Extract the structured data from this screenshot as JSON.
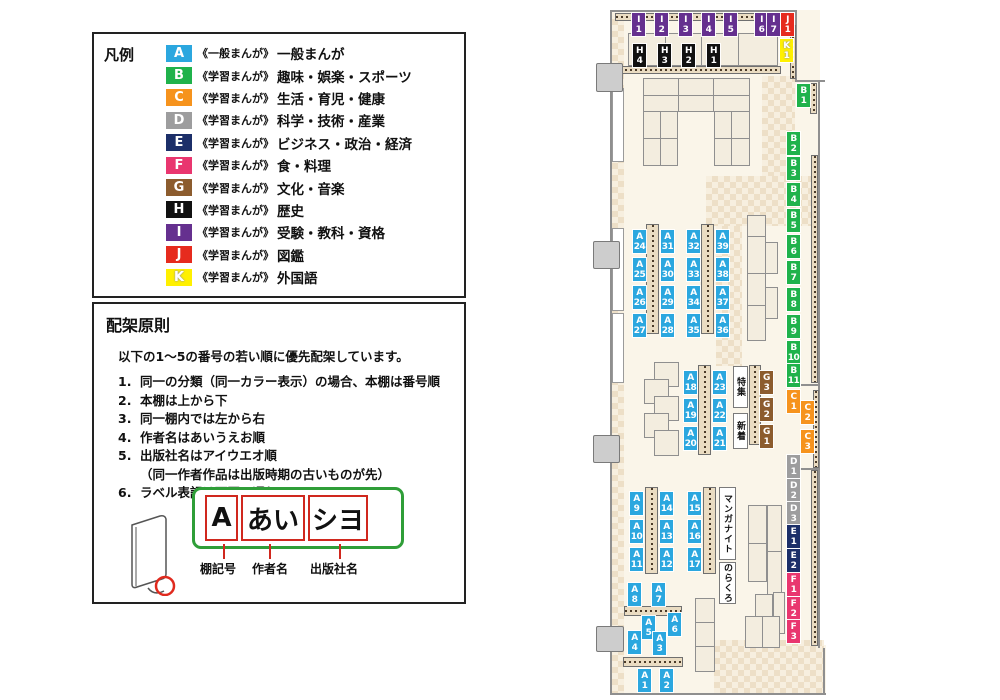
{
  "legend": {
    "title": "凡例",
    "items": [
      {
        "code": "A",
        "color": "#2BA7DF",
        "category": "《一般まんが》",
        "label": "一般まんが"
      },
      {
        "code": "B",
        "color": "#1FB24B",
        "category": "《学習まんが》",
        "label": "趣味・娯楽・スポーツ"
      },
      {
        "code": "C",
        "color": "#F6931D",
        "category": "《学習まんが》",
        "label": "生活・育児・健康"
      },
      {
        "code": "D",
        "color": "#9D9D9E",
        "category": "《学習まんが》",
        "label": "科学・技術・産業"
      },
      {
        "code": "E",
        "color": "#1C2F69",
        "category": "《学習まんが》",
        "label": "ビジネス・政治・経済"
      },
      {
        "code": "F",
        "color": "#E9366F",
        "category": "《学習まんが》",
        "label": "食・料理"
      },
      {
        "code": "G",
        "color": "#8C5C2E",
        "category": "《学習まんが》",
        "label": "文化・音楽"
      },
      {
        "code": "H",
        "color": "#111111",
        "category": "《学習まんが》",
        "label": "歴史"
      },
      {
        "code": "I",
        "color": "#65308F",
        "category": "《学習まんが》",
        "label": "受験・教科・資格"
      },
      {
        "code": "J",
        "color": "#E62B1E",
        "category": "《学習まんが》",
        "label": "図鑑"
      },
      {
        "code": "K",
        "color": "#FFF000",
        "category": "《学習まんが》",
        "label": "外国語"
      }
    ]
  },
  "principles": {
    "title": "配架原則",
    "intro": "以下の1〜5の番号の若い順に優先配架しています。",
    "rules": [
      {
        "n": "1.",
        "t": "同一の分類（同一カラー表示）の場合、本棚は番号順"
      },
      {
        "n": "2.",
        "t": "本棚は上から下"
      },
      {
        "n": "3.",
        "t": "同一棚内では左から右"
      },
      {
        "n": "4.",
        "t": "作者名はあいうえお順"
      },
      {
        "n": "5.",
        "t": "出版社名はアイウエオ順\n（同一作者作品は出版時期の古いものが先）"
      },
      {
        "n": "6.",
        "t": "ラベル表記は下図の通り"
      }
    ],
    "label_diagram": {
      "shelf_code": "A",
      "author": "あい",
      "publisher": "シヨ",
      "captions": [
        "棚記号",
        "作者名",
        "出版社名"
      ]
    }
  },
  "map": {
    "palette": {
      "A": "#2BA7DF",
      "B": "#1FB24B",
      "C": "#F6931D",
      "D": "#9D9D9E",
      "E": "#1C2F69",
      "F": "#E9366F",
      "G": "#8C5C2E",
      "H": "#111111",
      "I": "#65308F",
      "J": "#E62B1E",
      "K": "#FFF000"
    },
    "shelf_labels": [
      {
        "code": "I1",
        "x": 632,
        "y": 13
      },
      {
        "code": "I2",
        "x": 655,
        "y": 13
      },
      {
        "code": "I3",
        "x": 679,
        "y": 13
      },
      {
        "code": "I4",
        "x": 702,
        "y": 13
      },
      {
        "code": "I5",
        "x": 724,
        "y": 13
      },
      {
        "code": "I6",
        "x": 755,
        "y": 13
      },
      {
        "code": "I7",
        "x": 767,
        "y": 13
      },
      {
        "code": "J1",
        "x": 781,
        "y": 13
      },
      {
        "code": "K1",
        "x": 780,
        "y": 39
      },
      {
        "code": "H4",
        "x": 633,
        "y": 44
      },
      {
        "code": "H3",
        "x": 658,
        "y": 44
      },
      {
        "code": "H2",
        "x": 682,
        "y": 44
      },
      {
        "code": "H1",
        "x": 707,
        "y": 44
      },
      {
        "code": "B1",
        "x": 797,
        "y": 84
      },
      {
        "code": "B2",
        "x": 787,
        "y": 132
      },
      {
        "code": "B3",
        "x": 787,
        "y": 157
      },
      {
        "code": "B4",
        "x": 787,
        "y": 183
      },
      {
        "code": "B5",
        "x": 787,
        "y": 209
      },
      {
        "code": "B6",
        "x": 787,
        "y": 235
      },
      {
        "code": "B7",
        "x": 787,
        "y": 261
      },
      {
        "code": "B8",
        "x": 787,
        "y": 288
      },
      {
        "code": "B9",
        "x": 787,
        "y": 315
      },
      {
        "code": "B10",
        "x": 787,
        "y": 341
      },
      {
        "code": "B11",
        "x": 787,
        "y": 364
      },
      {
        "code": "C1",
        "x": 787,
        "y": 390
      },
      {
        "code": "C2",
        "x": 801,
        "y": 401
      },
      {
        "code": "C3",
        "x": 801,
        "y": 430
      },
      {
        "code": "D1",
        "x": 787,
        "y": 455
      },
      {
        "code": "D2",
        "x": 787,
        "y": 479
      },
      {
        "code": "D3",
        "x": 787,
        "y": 502
      },
      {
        "code": "E1",
        "x": 787,
        "y": 525
      },
      {
        "code": "E2",
        "x": 787,
        "y": 549
      },
      {
        "code": "F1",
        "x": 787,
        "y": 573
      },
      {
        "code": "F2",
        "x": 787,
        "y": 597
      },
      {
        "code": "F3",
        "x": 787,
        "y": 620
      },
      {
        "code": "G3",
        "x": 760,
        "y": 371
      },
      {
        "code": "G2",
        "x": 760,
        "y": 398
      },
      {
        "code": "G1",
        "x": 760,
        "y": 425
      },
      {
        "code": "A24",
        "x": 633,
        "y": 230
      },
      {
        "code": "A25",
        "x": 633,
        "y": 258
      },
      {
        "code": "A26",
        "x": 633,
        "y": 286
      },
      {
        "code": "A27",
        "x": 633,
        "y": 314
      },
      {
        "code": "A31",
        "x": 661,
        "y": 230
      },
      {
        "code": "A30",
        "x": 661,
        "y": 258
      },
      {
        "code": "A29",
        "x": 661,
        "y": 286
      },
      {
        "code": "A28",
        "x": 661,
        "y": 314
      },
      {
        "code": "A32",
        "x": 687,
        "y": 230
      },
      {
        "code": "A33",
        "x": 687,
        "y": 258
      },
      {
        "code": "A34",
        "x": 687,
        "y": 286
      },
      {
        "code": "A35",
        "x": 687,
        "y": 314
      },
      {
        "code": "A39",
        "x": 716,
        "y": 230
      },
      {
        "code": "A38",
        "x": 716,
        "y": 258
      },
      {
        "code": "A37",
        "x": 716,
        "y": 286
      },
      {
        "code": "A36",
        "x": 716,
        "y": 314
      },
      {
        "code": "A18",
        "x": 684,
        "y": 371
      },
      {
        "code": "A19",
        "x": 684,
        "y": 399
      },
      {
        "code": "A20",
        "x": 684,
        "y": 427
      },
      {
        "code": "A23",
        "x": 713,
        "y": 371
      },
      {
        "code": "A22",
        "x": 713,
        "y": 399
      },
      {
        "code": "A21",
        "x": 713,
        "y": 427
      },
      {
        "code": "A9",
        "x": 630,
        "y": 492
      },
      {
        "code": "A10",
        "x": 630,
        "y": 520
      },
      {
        "code": "A11",
        "x": 630,
        "y": 548
      },
      {
        "code": "A14",
        "x": 660,
        "y": 492
      },
      {
        "code": "A13",
        "x": 660,
        "y": 520
      },
      {
        "code": "A12",
        "x": 660,
        "y": 548
      },
      {
        "code": "A15",
        "x": 688,
        "y": 492
      },
      {
        "code": "A16",
        "x": 688,
        "y": 520
      },
      {
        "code": "A17",
        "x": 688,
        "y": 548
      },
      {
        "code": "A8",
        "x": 628,
        "y": 583
      },
      {
        "code": "A7",
        "x": 652,
        "y": 583
      },
      {
        "code": "A5",
        "x": 642,
        "y": 616
      },
      {
        "code": "A6",
        "x": 668,
        "y": 613
      },
      {
        "code": "A4",
        "x": 628,
        "y": 631
      },
      {
        "code": "A3",
        "x": 653,
        "y": 632
      },
      {
        "code": "A1",
        "x": 638,
        "y": 669
      },
      {
        "code": "A2",
        "x": 660,
        "y": 669
      }
    ],
    "signs": [
      {
        "name": "tokushu-sign",
        "text": "特集",
        "x": 733,
        "y": 366,
        "w": 15,
        "h": 42
      },
      {
        "name": "shinchaku-sign",
        "text": "新着",
        "x": 733,
        "y": 413,
        "w": 15,
        "h": 36
      },
      {
        "name": "manga-night-sign",
        "text": "マンガナイト",
        "x": 719,
        "y": 487,
        "w": 17,
        "h": 73
      },
      {
        "name": "norakuro-sign",
        "text": "のらくろ",
        "x": 719,
        "y": 562,
        "w": 17,
        "h": 42
      }
    ]
  }
}
